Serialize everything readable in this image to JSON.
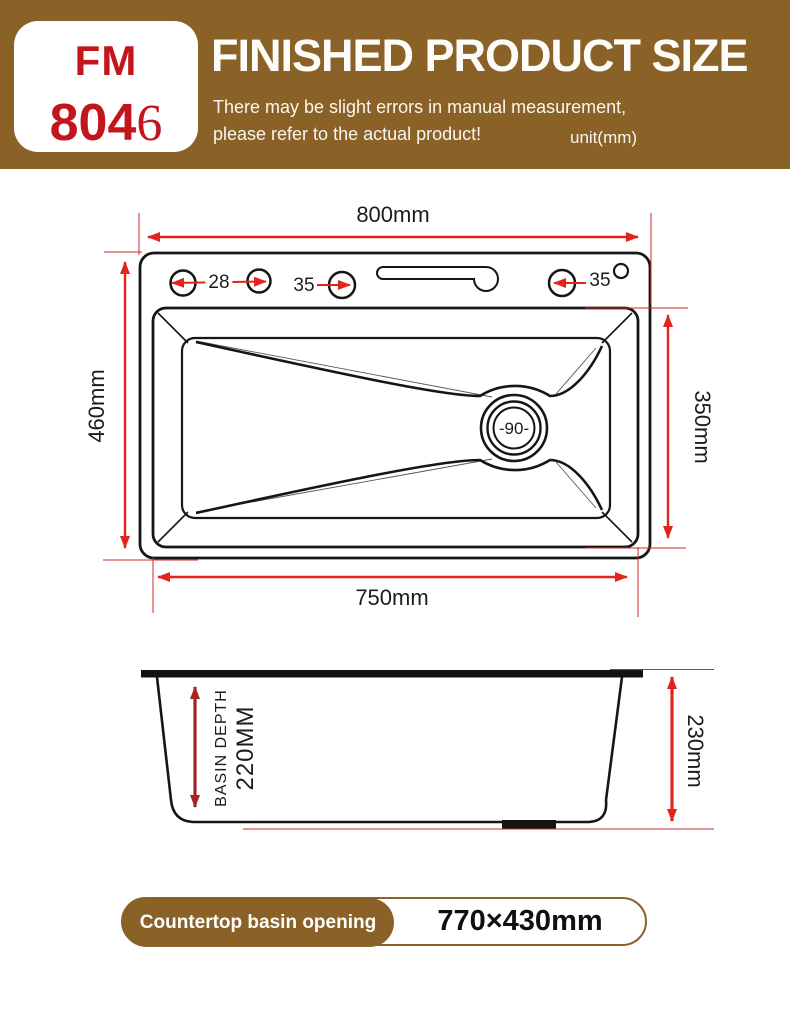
{
  "header": {
    "model_prefix": "FM",
    "model_number_main": "804",
    "model_number_suffix": "6",
    "title": "FINISHED PRODUCT SIZE",
    "subtitle_line1": "There may be slight errors in manual measurement,",
    "subtitle_line2": "please refer to the actual product!",
    "unit_label": "unit(mm)"
  },
  "top_view": {
    "overall_width": "800mm",
    "overall_depth": "460mm",
    "inner_length": "750mm",
    "inner_width": "350mm",
    "hole_diameter_28": "28",
    "hole_diameter_35_left": "35",
    "hole_diameter_35_right": "35",
    "drain_diameter": "-90-"
  },
  "side_view": {
    "basin_depth_label": "BASIN DEPTH",
    "basin_depth_value": "220MM",
    "overall_height": "230mm"
  },
  "footer": {
    "opening_label": "Countertop basin opening",
    "opening_size": "770×430mm"
  },
  "colors": {
    "header_brown": "#8a6228",
    "model_red": "#c3161c",
    "dimension_red": "#e2241c",
    "dark_red": "#a62421",
    "line_black": "#1a1a1a"
  }
}
